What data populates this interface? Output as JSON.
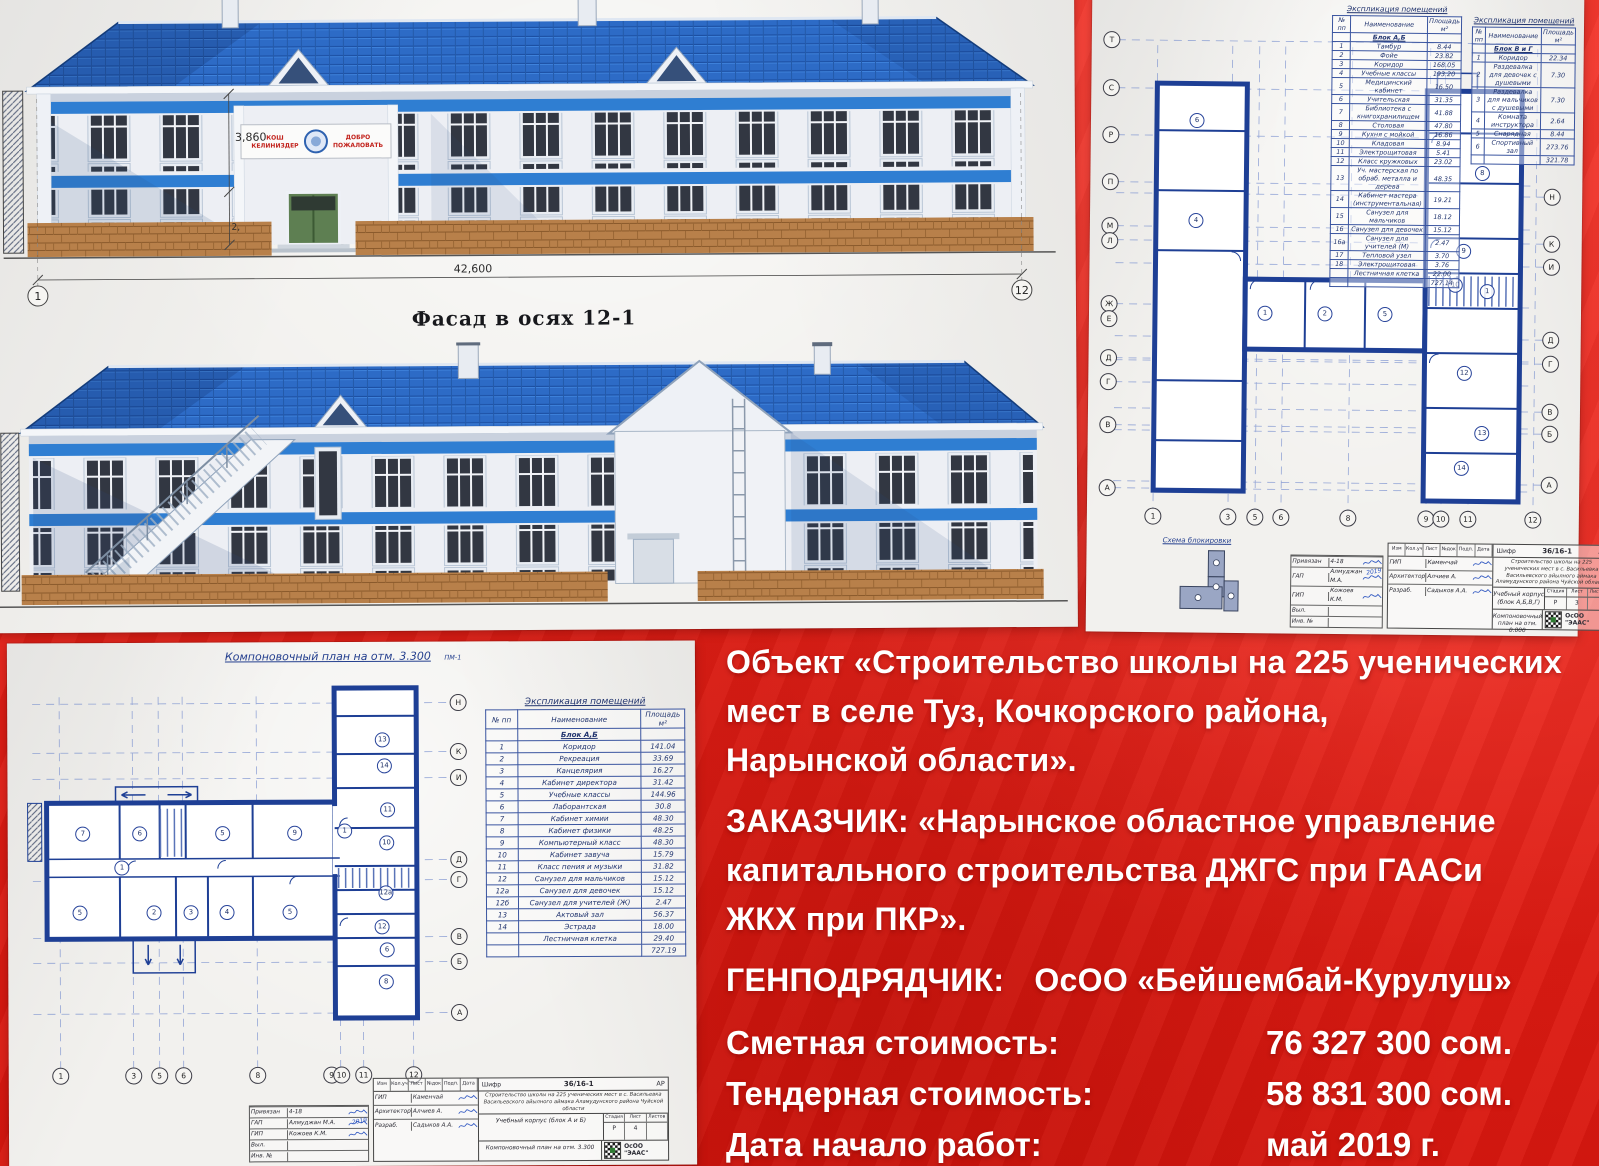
{
  "red_panel": {
    "object_lines": [
      "Объект «Строительство школы на 225 ученических",
      "мест в селе Туз, Кочкорского района,",
      "Нарынской области»."
    ],
    "customer_lines": [
      "ЗАКАЗЧИК: «Нарынское областное управление",
      "капитального строительства ДЖГС при ГААСи",
      "ЖКХ при ПКР»."
    ],
    "contractor_label": "ГЕНПОДРЯДЧИК:",
    "contractor_value": "ОсОО «Бейшембай-Курулуш»",
    "cost_rows": [
      {
        "label": "Сметная стоимость:",
        "value": "76 327 300 сом."
      },
      {
        "label": "Тендерная стоимость:",
        "value": "58 831 300 сом."
      },
      {
        "label": "Дата начало работ:",
        "value": "май 2019 г."
      }
    ],
    "colors": {
      "banner_red": "#e32019",
      "text_white": "#ffffff"
    }
  },
  "facade_sheet": {
    "label": "Фасад в осях  12-1",
    "dim_width": "42,600",
    "dim_height_upper": "3,860",
    "dim_height_lower": "2,",
    "axis_start": "1",
    "axis_end": "12",
    "welcome_left_1": "КОШ",
    "welcome_left_2": "КЕЛИНИЗДЕР",
    "welcome_right_1": "ДОБРО",
    "welcome_right_2": "ПОЖАЛОВАТЬ",
    "colors": {
      "roof_blue": "#2d6bc6",
      "band_blue": "#2f7ed2",
      "brick": "#b8804a"
    }
  },
  "plan_sheet_top": {
    "table_left": {
      "title": "Экспликация помещений",
      "headers": [
        "№ пп",
        "Наименование",
        "Площадь м²"
      ],
      "block_label": "Блок А,Б",
      "rows": [
        [
          "1",
          "Тамбур",
          "8.44"
        ],
        [
          "2",
          "Фойе",
          "23.82"
        ],
        [
          "3",
          "Коридор",
          "168.05"
        ],
        [
          "4",
          "Учебные классы",
          "193.20"
        ],
        [
          "5",
          "Медицинский кабинет",
          "16.50"
        ],
        [
          "6",
          "Учительская",
          "31.35"
        ],
        [
          "7",
          "Библиотека с книгохранилищем",
          "41.88"
        ],
        [
          "8",
          "Столовая",
          "47.80"
        ],
        [
          "9",
          "Кухня с мойкой",
          "16.86"
        ],
        [
          "10",
          "Кладовая",
          "8.94"
        ],
        [
          "11",
          "Электрощитовая",
          "5.41"
        ],
        [
          "12",
          "Класс кружковых",
          "23.02"
        ],
        [
          "13",
          "Уч. мастерская по обраб. металла и дерева",
          "48.35"
        ],
        [
          "14",
          "Кабинет мастера (инструментальная)",
          "19.21"
        ],
        [
          "15",
          "Санузел для мальчиков",
          "18.12"
        ],
        [
          "16",
          "Санузел для девочек",
          "15.12"
        ],
        [
          "16а",
          "Санузел для учителей (М)",
          "2.47"
        ],
        [
          "17",
          "Тепловой узел",
          "3.70"
        ],
        [
          "18",
          "Электрощитовая",
          "3.76"
        ],
        [
          "",
          "Лестничная клетка",
          "22.00"
        ],
        [
          "",
          "",
          "727.14"
        ]
      ]
    },
    "table_right": {
      "title": "Экспликация помещений",
      "headers": [
        "№ пп",
        "Наименование",
        "Площадь м²"
      ],
      "block_label": "Блок В и Г",
      "rows": [
        [
          "1",
          "Коридор",
          "22.34"
        ],
        [
          "2",
          "Раздевалка для девочек с душевыми",
          "7.30"
        ],
        [
          "3",
          "Раздевалка для мальчиков с душевыми",
          "7.30"
        ],
        [
          "4",
          "Комната инструктора",
          "2.64"
        ],
        [
          "5",
          "Снарядная",
          "8.44"
        ],
        [
          "6",
          "Спортивный зал",
          "273.76"
        ],
        [
          "",
          "",
          "321.78"
        ]
      ]
    },
    "blocking_label": "Схема блокировки",
    "stamp": {
      "shifr_label": "Шифр",
      "shifr": "36/16-1",
      "mark": "АР",
      "project": "Строительство школы на 225 ученических мест в с. Васильевка Васильевского айылного аймака Аламудунского района Чуйской области",
      "object": "Учебный корпус (блок А,Б,В,Г)",
      "stage_headers": [
        "Стадия",
        "Лист",
        "Листов"
      ],
      "stage": "Р",
      "sheet_no": "3",
      "sheets_total": "",
      "drawing": "Компоновочный план на отм. 0.000",
      "firm": "ОсОО \"ЭААС\"",
      "header_cols": [
        "Изм",
        "Кол.уч",
        "Лист",
        "№док",
        "Подп.",
        "Дата"
      ],
      "binding": [
        [
          "Привязан",
          "4-18"
        ],
        [
          "ГАП",
          "Алмуджан М.А."
        ],
        [
          "ГИП",
          "Кожоев К.М."
        ],
        [
          "Выл.",
          ""
        ],
        [
          "Инв. №",
          ""
        ]
      ],
      "execs": [
        [
          "ГИП",
          "Каменчай"
        ],
        [
          "Архитектор",
          "Алчиев А."
        ],
        [
          "Разраб.",
          "Садыков А.А."
        ]
      ],
      "sig_year": "2019"
    },
    "circles": [
      {
        "t": "Т",
        "x": 3,
        "y": 3.4,
        "k": "a"
      },
      {
        "t": "С",
        "x": 3,
        "y": 11.5,
        "k": "a"
      },
      {
        "t": "Р",
        "x": 3,
        "y": 19.5,
        "k": "a"
      },
      {
        "t": "П",
        "x": 3,
        "y": 27.5,
        "k": "a"
      },
      {
        "t": "М",
        "x": 3,
        "y": 34.9,
        "k": "a"
      },
      {
        "t": "Л",
        "x": 3,
        "y": 37.4,
        "k": "a"
      },
      {
        "t": "Ж",
        "x": 3,
        "y": 48.1,
        "k": "a"
      },
      {
        "t": "Е",
        "x": 3,
        "y": 50.6,
        "k": "a"
      },
      {
        "t": "Д",
        "x": 3,
        "y": 57.3,
        "k": "a"
      },
      {
        "t": "Г",
        "x": 3,
        "y": 61.4,
        "k": "a"
      },
      {
        "t": "В",
        "x": 3,
        "y": 68.6,
        "k": "a"
      },
      {
        "t": "А",
        "x": 3,
        "y": 79.3,
        "k": "a"
      },
      {
        "t": "Н",
        "x": 97,
        "y": 29.3,
        "k": "a"
      },
      {
        "t": "К",
        "x": 97,
        "y": 37.3,
        "k": "a"
      },
      {
        "t": "И",
        "x": 97,
        "y": 41.2,
        "k": "a"
      },
      {
        "t": "Д",
        "x": 97,
        "y": 53.6,
        "k": "a"
      },
      {
        "t": "Г",
        "x": 97,
        "y": 57.6,
        "k": "a"
      },
      {
        "t": "В",
        "x": 97,
        "y": 65.8,
        "k": "a"
      },
      {
        "t": "Б",
        "x": 97,
        "y": 69.5,
        "k": "a"
      },
      {
        "t": "А",
        "x": 97,
        "y": 78.1,
        "k": "a"
      },
      {
        "t": "1",
        "x": 12.8,
        "y": 84,
        "k": "a"
      },
      {
        "t": "3",
        "x": 28.7,
        "y": 84,
        "k": "a"
      },
      {
        "t": "5",
        "x": 34.5,
        "y": 84,
        "k": "a"
      },
      {
        "t": "6",
        "x": 40,
        "y": 84,
        "k": "a"
      },
      {
        "t": "8",
        "x": 54.3,
        "y": 84,
        "k": "a"
      },
      {
        "t": "9",
        "x": 70.9,
        "y": 84,
        "k": "a"
      },
      {
        "t": "10",
        "x": 74,
        "y": 84,
        "k": "a"
      },
      {
        "t": "11",
        "x": 79.8,
        "y": 84,
        "k": "a"
      },
      {
        "t": "12",
        "x": 93.6,
        "y": 84,
        "k": "a"
      },
      {
        "t": "6",
        "x": 21.3,
        "y": 16.9,
        "k": "r"
      },
      {
        "t": "4",
        "x": 21.3,
        "y": 33.9,
        "k": "r"
      },
      {
        "t": "1",
        "x": 36.2,
        "y": 49.5,
        "k": "r"
      },
      {
        "t": "2",
        "x": 48.9,
        "y": 49.5,
        "k": "r"
      },
      {
        "t": "5",
        "x": 61.7,
        "y": 49.5,
        "k": "r"
      },
      {
        "t": "8",
        "x": 82.1,
        "y": 25.4,
        "k": "r"
      },
      {
        "t": "9",
        "x": 78.3,
        "y": 38.6,
        "k": "r"
      },
      {
        "t": "10",
        "x": 76.6,
        "y": 44.4,
        "k": "r"
      },
      {
        "t": "1",
        "x": 83.4,
        "y": 45.4,
        "k": "r"
      },
      {
        "t": "12",
        "x": 78.7,
        "y": 59.3,
        "k": "r"
      },
      {
        "t": "13",
        "x": 82.6,
        "y": 69.5,
        "k": "r"
      },
      {
        "t": "14",
        "x": 78.3,
        "y": 75.4,
        "k": "r"
      }
    ]
  },
  "plan_sheet_bottom": {
    "plan_title": "Компоновочный план на отм. 3.300",
    "plan_note": "ПМ-1",
    "table": {
      "title": "Экспликация помещений",
      "headers": [
        "№ пп",
        "Наименование",
        "Площадь м²"
      ],
      "block_label": "Блок А,Б",
      "rows": [
        [
          "1",
          "Коридор",
          "141.04"
        ],
        [
          "2",
          "Рекреация",
          "33.69"
        ],
        [
          "3",
          "Канцелярия",
          "16.27"
        ],
        [
          "4",
          "Кабинет директора",
          "31.42"
        ],
        [
          "5",
          "Учебные классы",
          "144.96"
        ],
        [
          "6",
          "Лаборантская",
          "30.8"
        ],
        [
          "7",
          "Кабинет химии",
          "48.30"
        ],
        [
          "8",
          "Кабинет физики",
          "48.25"
        ],
        [
          "9",
          "Компьютерный класс",
          "48.30"
        ],
        [
          "10",
          "Кабинет завуча",
          "15.79"
        ],
        [
          "11",
          "Класс пения и музыки",
          "31.82"
        ],
        [
          "12",
          "Санузел для мальчиков",
          "15.12"
        ],
        [
          "12а",
          "Санузел для девочек",
          "15.12"
        ],
        [
          "12б",
          "Санузел для учителей (Ж)",
          "2.47"
        ],
        [
          "13",
          "Актовый зал",
          "56.37"
        ],
        [
          "14",
          "Эстрада",
          "18.00"
        ],
        [
          "",
          "Лестничная клетка",
          "29.40"
        ],
        [
          "",
          "",
          "727.19"
        ]
      ]
    },
    "stamp": {
      "shifr_label": "Шифр",
      "shifr": "36/16-1",
      "mark": "АР",
      "project": "Строительство школы на 225 ученических мест в с. Васильевка Васильевского айылного аймака Аламудунского района Чуйской области",
      "object": "Учебный корпус (блок А и Б)",
      "stage_headers": [
        "Стадия",
        "Лист",
        "Листов"
      ],
      "stage": "Р",
      "sheet_no": "4",
      "sheets_total": "",
      "drawing": "Компоновочный план на отм. 3.300",
      "firm": "ОсОО \"ЭААС\"",
      "header_cols": [
        "Изм",
        "Кол.уч",
        "Лист",
        "№док",
        "Подп.",
        "Дата"
      ],
      "binding": [
        [
          "Привязан",
          "4-18"
        ],
        [
          "ГАП",
          "Алмуджан М.А."
        ],
        [
          "ГИП",
          "Кожоев К.М."
        ],
        [
          "Выл.",
          ""
        ],
        [
          "Инв. №",
          ""
        ]
      ],
      "execs": [
        [
          "ГИП",
          "Каменчай"
        ],
        [
          "Архитектор",
          "Алчиев А."
        ],
        [
          "Разраб.",
          "Садыков А.А."
        ]
      ],
      "sig_year": "2019"
    },
    "circles": [
      {
        "t": "Н",
        "x": 96,
        "y": 6.1,
        "k": "a"
      },
      {
        "t": "К",
        "x": 96,
        "y": 17.2,
        "k": "a"
      },
      {
        "t": "И",
        "x": 96,
        "y": 23.1,
        "k": "a"
      },
      {
        "t": "Д",
        "x": 96,
        "y": 41.6,
        "k": "a"
      },
      {
        "t": "Г",
        "x": 96,
        "y": 46.2,
        "k": "a"
      },
      {
        "t": "В",
        "x": 96,
        "y": 59,
        "k": "a"
      },
      {
        "t": "Б",
        "x": 96,
        "y": 64.7,
        "k": "a"
      },
      {
        "t": "А",
        "x": 96,
        "y": 76.2,
        "k": "a"
      },
      {
        "t": "1",
        "x": 11.1,
        "y": 90.3,
        "k": "a"
      },
      {
        "t": "3",
        "x": 26.6,
        "y": 90.3,
        "k": "a"
      },
      {
        "t": "5",
        "x": 32.1,
        "y": 90.3,
        "k": "a"
      },
      {
        "t": "6",
        "x": 37.2,
        "y": 90.3,
        "k": "a"
      },
      {
        "t": "8",
        "x": 53,
        "y": 90.3,
        "k": "a"
      },
      {
        "t": "9",
        "x": 68.7,
        "y": 90.3,
        "k": "a"
      },
      {
        "t": "10",
        "x": 70.8,
        "y": 90.3,
        "k": "a"
      },
      {
        "t": "11",
        "x": 75.5,
        "y": 90.3,
        "k": "a"
      },
      {
        "t": "12",
        "x": 86.2,
        "y": 90.3,
        "k": "a"
      },
      {
        "t": "7",
        "x": 16,
        "y": 35.5,
        "k": "r"
      },
      {
        "t": "6",
        "x": 28.1,
        "y": 35.5,
        "k": "r"
      },
      {
        "t": "5",
        "x": 45.7,
        "y": 35.5,
        "k": "r"
      },
      {
        "t": "9",
        "x": 61.1,
        "y": 35.5,
        "k": "r"
      },
      {
        "t": "1",
        "x": 24.3,
        "y": 43.2,
        "k": "r"
      },
      {
        "t": "5",
        "x": 15.3,
        "y": 53.4,
        "k": "r"
      },
      {
        "t": "2",
        "x": 31.1,
        "y": 53.4,
        "k": "r"
      },
      {
        "t": "3",
        "x": 38.9,
        "y": 53.4,
        "k": "r"
      },
      {
        "t": "4",
        "x": 46.6,
        "y": 53.4,
        "k": "r"
      },
      {
        "t": "5",
        "x": 60,
        "y": 53.4,
        "k": "r"
      },
      {
        "t": "13",
        "x": 79.8,
        "y": 14.5,
        "k": "r"
      },
      {
        "t": "14",
        "x": 80.2,
        "y": 20.4,
        "k": "r"
      },
      {
        "t": "11",
        "x": 80.9,
        "y": 30.3,
        "k": "r"
      },
      {
        "t": "10",
        "x": 80.6,
        "y": 37.8,
        "k": "r"
      },
      {
        "t": "12а",
        "x": 80.4,
        "y": 49.1,
        "k": "r"
      },
      {
        "t": "12",
        "x": 79.6,
        "y": 56.8,
        "k": "r"
      },
      {
        "t": "6",
        "x": 80.6,
        "y": 62,
        "k": "r"
      },
      {
        "t": "8",
        "x": 80.4,
        "y": 69.2,
        "k": "r"
      },
      {
        "t": "1",
        "x": 71.7,
        "y": 35.1,
        "k": "r"
      }
    ]
  }
}
